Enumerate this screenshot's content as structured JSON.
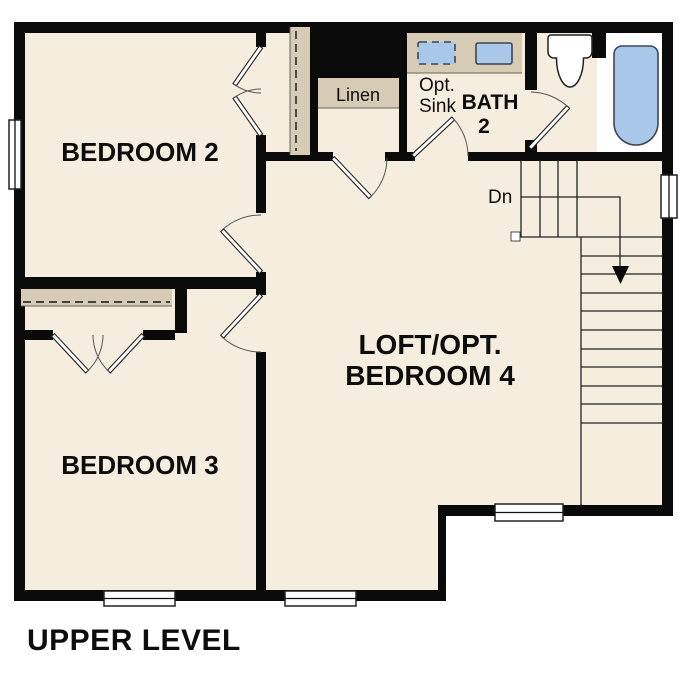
{
  "plan_title": "UPPER LEVEL",
  "labels": {
    "bedroom2": "BEDROOM 2",
    "bedroom3": "BEDROOM 3",
    "loft_line1": "LOFT/OPT.",
    "loft_line2": "BEDROOM 4",
    "bath_line1": "BATH",
    "bath_line2": "2",
    "opt_sink_line1": "Opt.",
    "opt_sink_line2": "Sink",
    "linen": "Linen",
    "stairs_down": "Dn"
  },
  "colors": {
    "background": "#ffffff",
    "floor": "#f5edde",
    "wall": "#0a0a0a",
    "casework": "#d6cbb4",
    "fixture_blue": "#a9c8e9",
    "line": "#222222"
  }
}
